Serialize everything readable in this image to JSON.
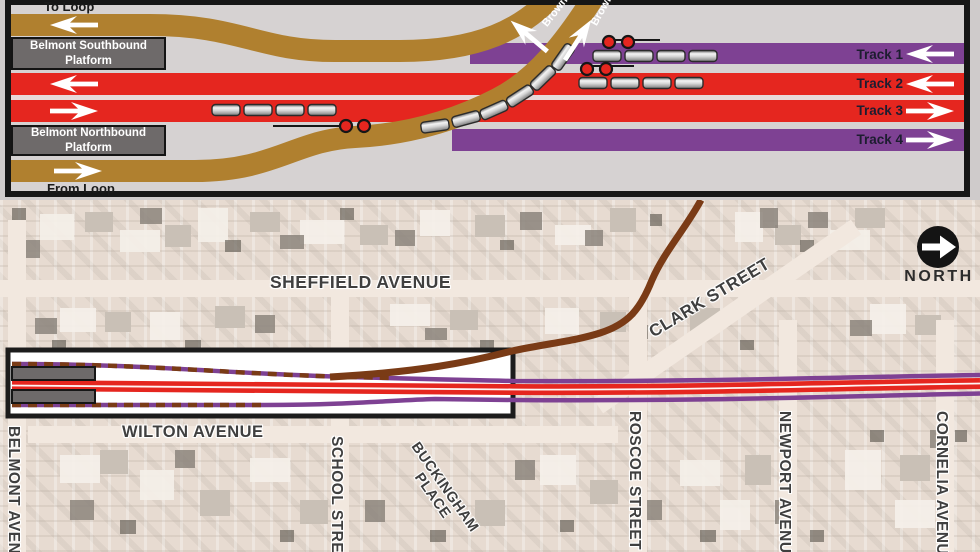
{
  "schematic": {
    "to_loop_label": "To Loop",
    "from_loop_label": "From Loop",
    "southbound_platform_line1": "Belmont Southbound",
    "southbound_platform_line2": "Platform",
    "northbound_platform_line1": "Belmont Northbound",
    "northbound_platform_line2": "Platform",
    "brown_line_label": "Brown",
    "tracks": [
      {
        "label": "Track 1",
        "direction": "left",
        "color": "#7e4193"
      },
      {
        "label": "Track 2",
        "direction": "left",
        "color": "#e5261f"
      },
      {
        "label": "Track 3",
        "direction": "right",
        "color": "#e5261f"
      },
      {
        "label": "Track 4",
        "direction": "right",
        "color": "#7e4193"
      }
    ]
  },
  "map": {
    "north_label": "NORTH",
    "streets": {
      "sheffield": "SHEFFIELD AVENUE",
      "clark": "CLARK STREET",
      "wilton": "WILTON AVENUE",
      "belmont": "BELMONT AVENUE",
      "school": "SCHOOL STREET",
      "buckingham_line1": "BUCKINGHAM",
      "buckingham_line2": "PLACE",
      "roscoe": "ROSCOE STREET",
      "newport": "NEWPORT AVENUE",
      "cornelia": "CORNELIA AVENUE"
    }
  },
  "colors": {
    "schematic_brown": "#b0802f",
    "map_brown": "#7a3b16",
    "red": "#e5261f",
    "purple": "#7e4193",
    "platform_gray": "#6e6a6a"
  }
}
